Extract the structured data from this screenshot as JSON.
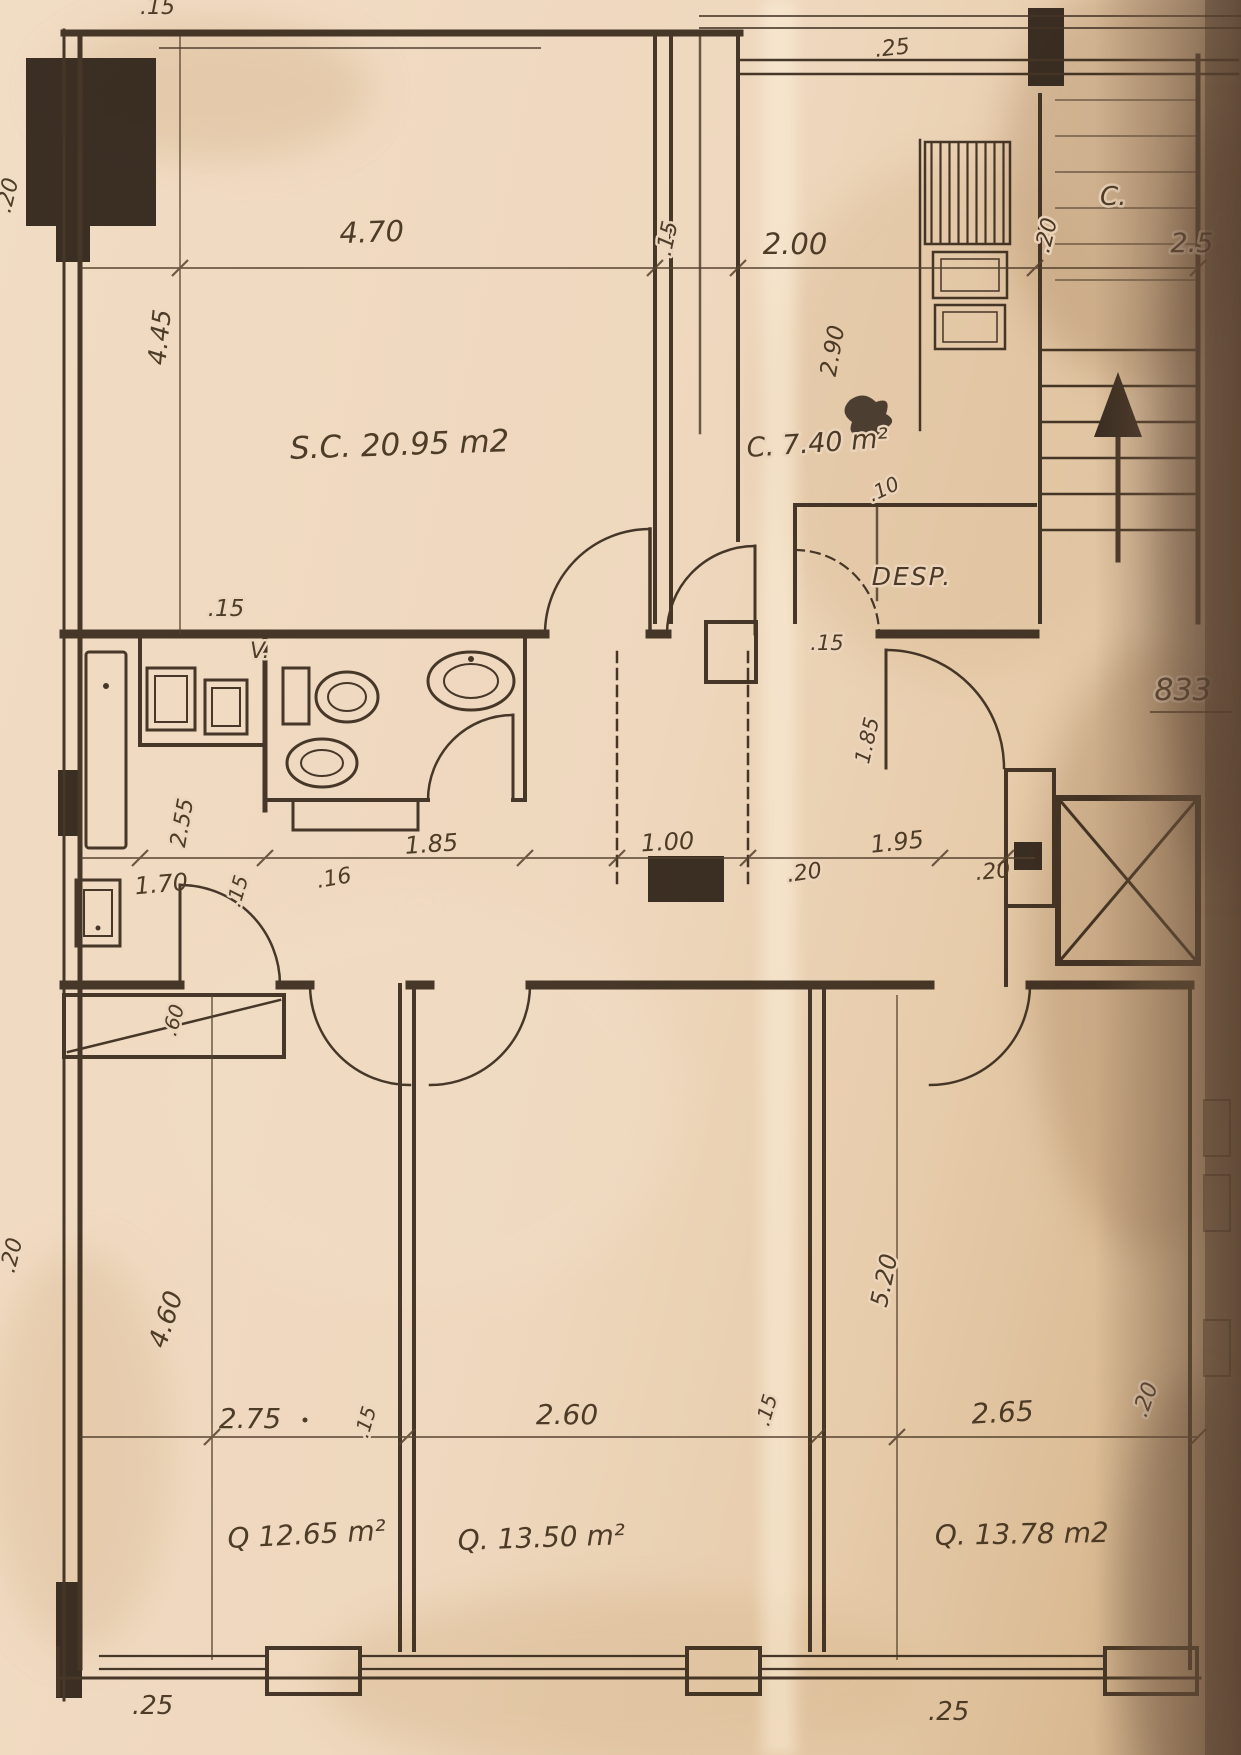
{
  "plan": {
    "sheet_number": "833",
    "rooms": {
      "living": {
        "label": "S.C. 20.95 m2"
      },
      "kitchen": {
        "label": "C. 7.40 m²",
        "corner_tag": "C."
      },
      "pantry": {
        "label": "DESP."
      },
      "vent_shaft": {
        "label": "V."
      },
      "bedroom1": {
        "label": "Q 12.65 m²"
      },
      "bedroom2": {
        "label": "Q. 13.50 m²"
      },
      "bedroom3": {
        "label": "Q. 13.78 m2"
      }
    },
    "dims": {
      "top_edge_partial": ".15",
      "living_w": "4.70",
      "living_h": "4.45",
      "sc_kitchen_wall": ".15",
      "kitchen_w": "2.00",
      "kitchen_top_wall": ".25",
      "kitchen_h": "2.90",
      "kitchen_right_wall": ".20",
      "stairs_w": "2.5",
      "pantry_gap": ".10",
      "hall_wall_label": ".15",
      "bath_top_wall": ".15",
      "vent_h": "2.55",
      "terrace_w": "1.70",
      "terrace_wall": ".15",
      "hall_wall_b": ".16",
      "bath_w": "1.85",
      "hall_w": "1.00",
      "hall_wall_c": ".20",
      "desp_w": "1.95",
      "hall_wall_d": ".20",
      "desp_h": "1.85",
      "closet_d": ".60",
      "left_edge_top": ".20",
      "left_edge_bottom": ".20",
      "bed1_h": "4.60",
      "bed1_w": "2.75",
      "bed_wall_a": ".15",
      "bed2_w": "2.60",
      "bed_wall_b": ".15",
      "bed3_w": "2.65",
      "bed3_right_wall": ".20",
      "bed3_h": "5.20",
      "bottom_wall_left": ".25",
      "bottom_wall_right": ".25"
    }
  }
}
